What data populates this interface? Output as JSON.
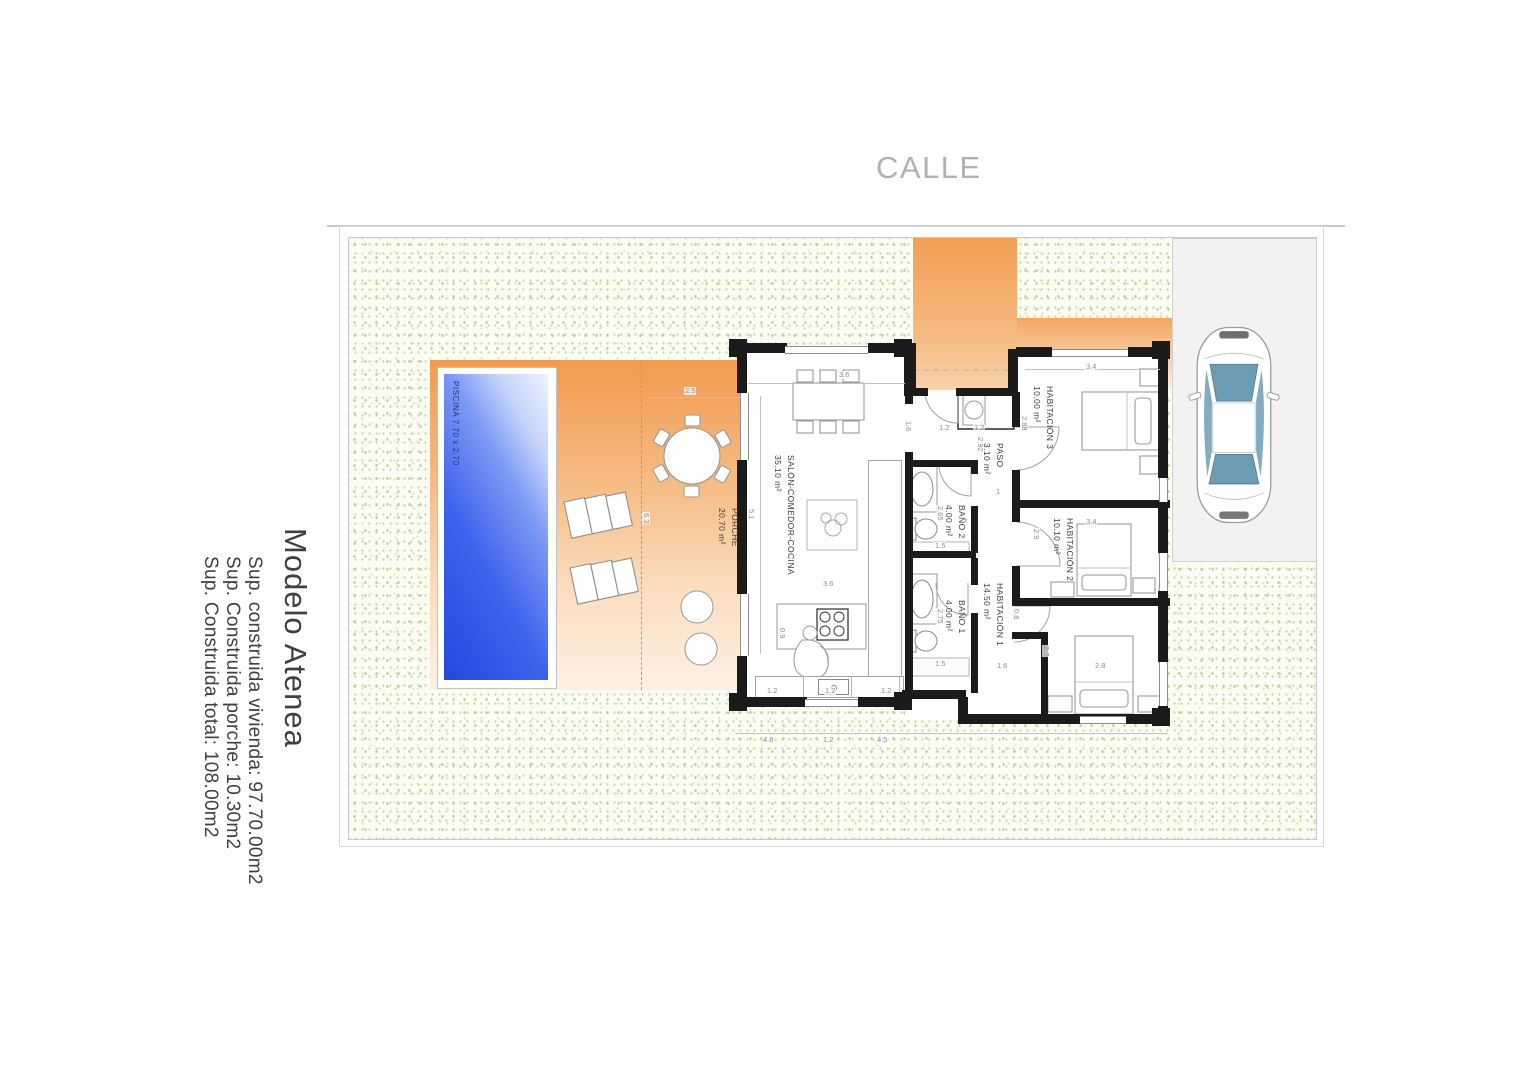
{
  "header": {
    "street_label": "CALLE"
  },
  "info_panel": {
    "title": "Modelo Atenea",
    "lines": [
      "Sup. construida vivienda: 97.70.00m2",
      "Sup. Construida porche: 10.30m2",
      "Sup. Construida total: 108.00m2"
    ]
  },
  "plan": {
    "pool": {
      "label": "PISCINA 7.70 x 2.70"
    },
    "rooms": [
      {
        "id": "porche",
        "name": "PORCHE",
        "area": "20.70 m²"
      },
      {
        "id": "salon",
        "name": "SALÓN-COMEDOR-COCINA",
        "area": "35.10 m²"
      },
      {
        "id": "paso",
        "name": "PASO",
        "area": "3.10 m²"
      },
      {
        "id": "bano2",
        "name": "BAÑO 2",
        "area": "4.00 m²"
      },
      {
        "id": "bano1",
        "name": "BAÑO 1",
        "area": "4.00 m²"
      },
      {
        "id": "hab3",
        "name": "HABITACIÓN 3",
        "area": "10.00 m²"
      },
      {
        "id": "hab2",
        "name": "HABITACIÓN 2",
        "area": "10.10 m²"
      },
      {
        "id": "hab1",
        "name": "HABITACIÓN 1",
        "area": "14.50 m²"
      }
    ],
    "dimensions": [
      {
        "t": "3.6",
        "x": 838,
        "y": 371,
        "r": 0
      },
      {
        "t": "5.1",
        "x": 755,
        "y": 508,
        "r": 90
      },
      {
        "t": "2.5",
        "x": 684,
        "y": 387,
        "r": 0
      },
      {
        "t": "6.3",
        "x": 650,
        "y": 512,
        "r": 90
      },
      {
        "t": "1.6",
        "x": 912,
        "y": 420,
        "r": 90
      },
      {
        "t": "1.2",
        "x": 938,
        "y": 424,
        "r": 0
      },
      {
        "t": "1.2",
        "x": 973,
        "y": 424,
        "r": 0
      },
      {
        "t": "2.92",
        "x": 984,
        "y": 436,
        "r": 90
      },
      {
        "t": "1",
        "x": 995,
        "y": 488,
        "r": 0
      },
      {
        "t": "2.65",
        "x": 944,
        "y": 505,
        "r": 90
      },
      {
        "t": "1.5",
        "x": 934,
        "y": 542,
        "r": 0
      },
      {
        "t": "2.75",
        "x": 944,
        "y": 608,
        "r": 90
      },
      {
        "t": "1.5",
        "x": 934,
        "y": 660,
        "r": 0
      },
      {
        "t": "3.4",
        "x": 1085,
        "y": 363,
        "r": 0
      },
      {
        "t": "2.88",
        "x": 1028,
        "y": 415,
        "r": 90
      },
      {
        "t": "3.4",
        "x": 1085,
        "y": 518,
        "r": 0
      },
      {
        "t": "2.9",
        "x": 1040,
        "y": 528,
        "r": 90
      },
      {
        "t": "0.8",
        "x": 1020,
        "y": 608,
        "r": 90
      },
      {
        "t": "2.7",
        "x": 1050,
        "y": 645,
        "r": 90
      },
      {
        "t": "2.8",
        "x": 1094,
        "y": 662,
        "r": 0
      },
      {
        "t": "1.6",
        "x": 996,
        "y": 662,
        "r": 0
      },
      {
        "t": "3.6",
        "x": 822,
        "y": 580,
        "r": 0
      },
      {
        "t": "0.9",
        "x": 786,
        "y": 627,
        "r": 90
      },
      {
        "t": "1.2",
        "x": 766,
        "y": 687,
        "r": 0
      },
      {
        "t": "1.2",
        "x": 824,
        "y": 687,
        "r": 0
      },
      {
        "t": "1.2",
        "x": 880,
        "y": 687,
        "r": 0
      },
      {
        "t": "4.8",
        "x": 762,
        "y": 736,
        "r": 0
      },
      {
        "t": "1.2",
        "x": 822,
        "y": 736,
        "r": 0
      },
      {
        "t": "4.5",
        "x": 876,
        "y": 736,
        "r": 0
      }
    ],
    "colors": {
      "terrace_orange": "#f19b4f",
      "pool_blue": "#2647de",
      "lawn_green": "#c3d6a2",
      "car_glass": "#6d9db4",
      "wall_black": "#1b1b1b"
    }
  }
}
